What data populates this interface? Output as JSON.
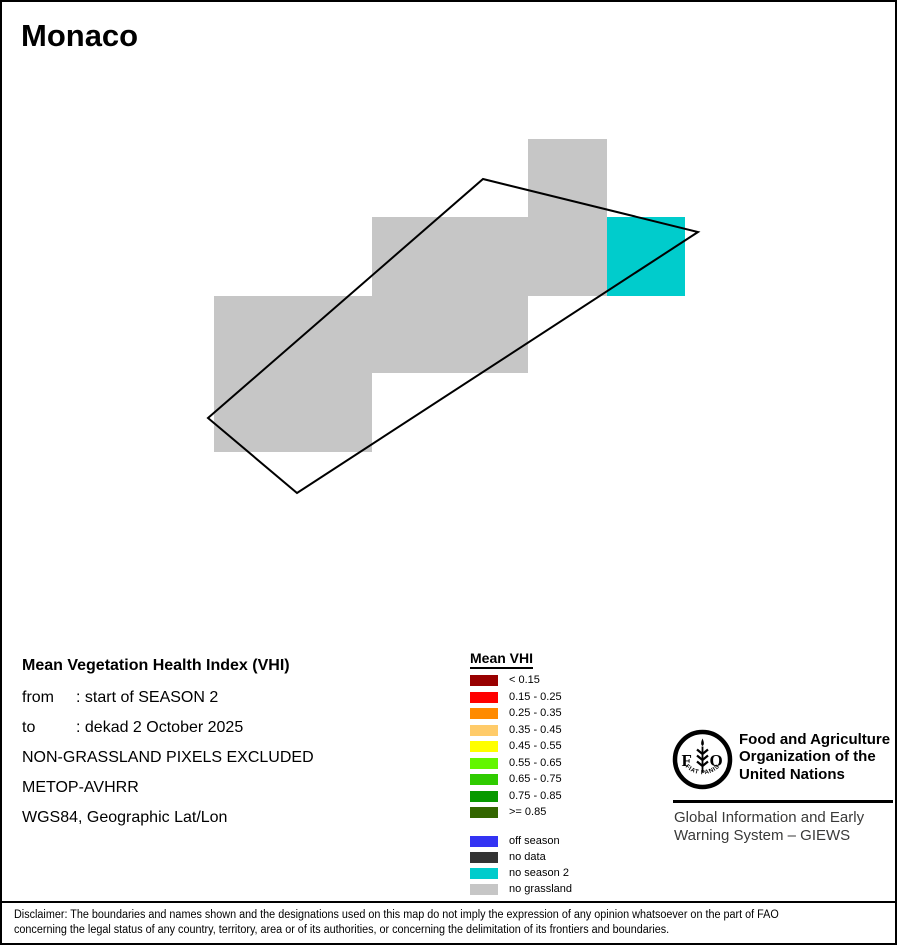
{
  "title": "Monaco",
  "info": {
    "heading": "Mean Vegetation Health Index (VHI)",
    "from_label": "from",
    "from_value": ": start of SEASON 2",
    "to_label": "to",
    "to_value": ": dekad 2 October 2025",
    "line_excluded": "NON-GRASSLAND PIXELS EXCLUDED",
    "line_sensor": "METOP-AVHRR",
    "line_projection": "WGS84, Geographic Lat/Lon"
  },
  "map": {
    "boundary_color": "#000000",
    "boundary_stroke_width": 2,
    "boundary_points": [
      [
        483,
        179
      ],
      [
        698,
        232
      ],
      [
        297,
        493
      ],
      [
        208,
        418
      ]
    ],
    "cells": [
      {
        "x": 528,
        "y": 139,
        "w": 79,
        "h": 78,
        "value": "no grassland",
        "color": "#C6C6C6"
      },
      {
        "x": 372,
        "y": 217,
        "w": 235,
        "h": 79,
        "value": "no grassland",
        "color": "#C6C6C6"
      },
      {
        "x": 607,
        "y": 217,
        "w": 78,
        "h": 79,
        "value": "no season 2",
        "color": "#00CCCC"
      },
      {
        "x": 214,
        "y": 296,
        "w": 314,
        "h": 77,
        "value": "no grassland",
        "color": "#C6C6C6"
      },
      {
        "x": 214,
        "y": 373,
        "w": 158,
        "h": 79,
        "value": "no grassland",
        "color": "#C6C6C6"
      }
    ]
  },
  "legend": {
    "title": "Mean VHI",
    "classes": [
      {
        "label": "< 0.15",
        "color": "#990000"
      },
      {
        "label": "0.15 - 0.25",
        "color": "#FF0000"
      },
      {
        "label": "0.25 - 0.35",
        "color": "#FF8A00"
      },
      {
        "label": "0.35 - 0.45",
        "color": "#FFCB69"
      },
      {
        "label": "0.45 - 0.55",
        "color": "#FFFF00"
      },
      {
        "label": "0.55 - 0.65",
        "color": "#63F600"
      },
      {
        "label": "0.65 - 0.75",
        "color": "#2FCB00"
      },
      {
        "label": "0.75 - 0.85",
        "color": "#089900"
      },
      {
        "label": ">= 0.85",
        "color": "#336600"
      }
    ],
    "extra_classes": [
      {
        "label": "off season",
        "color": "#3333F3"
      },
      {
        "label": "no data",
        "color": "#333333"
      },
      {
        "label": "no season 2",
        "color": "#00CCCC"
      },
      {
        "label": "no grassland",
        "color": "#C6C6C6"
      }
    ]
  },
  "fao": {
    "logo_letter_f": "F",
    "logo_letter_o": "O",
    "logo_motto": "FIAT PANIS",
    "org_name_lines": [
      "Food and Agriculture",
      "Organization of the",
      "United Nations"
    ],
    "giews_lines": [
      "Global Information and Early",
      "Warning System – GIEWS"
    ]
  },
  "disclaimer": {
    "line1": "Disclaimer: The boundaries and names shown and the designations used on this map do not imply the expression of any opinion whatsoever on the part of FAO",
    "line2": "concerning the legal status of any country, territory, area or of its authorities, or concerning the delimitation of its frontiers and boundaries."
  }
}
